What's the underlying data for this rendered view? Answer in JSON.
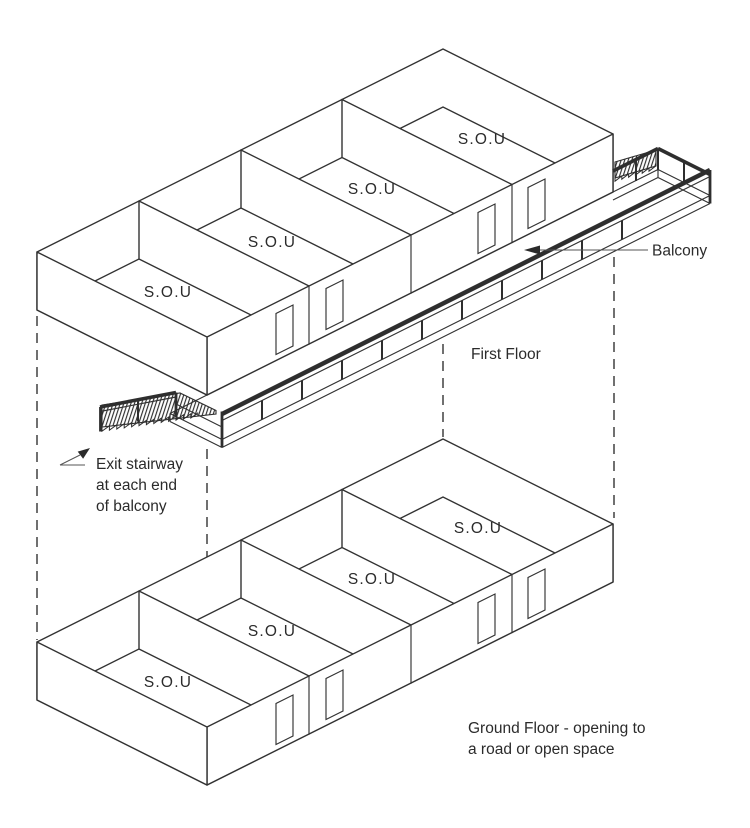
{
  "diagram": {
    "title": "Two-storey S.O.U building isometric diagram",
    "first_floor": {
      "label": "First Floor",
      "rooms": [
        "S.O.U",
        "S.O.U",
        "S.O.U",
        "S.O.U"
      ]
    },
    "ground_floor": {
      "caption_line1": "Ground Floor - opening to",
      "caption_line2": "a road or open space",
      "rooms": [
        "S.O.U",
        "S.O.U",
        "S.O.U",
        "S.O.U"
      ]
    },
    "balcony": {
      "label": "Balcony"
    },
    "exit_note": {
      "line1": "Exit stairway",
      "line2": "at each end",
      "line3": "of balcony"
    },
    "colors": {
      "line": "#333333",
      "text": "#2b2b2b",
      "background": "#ffffff"
    }
  }
}
